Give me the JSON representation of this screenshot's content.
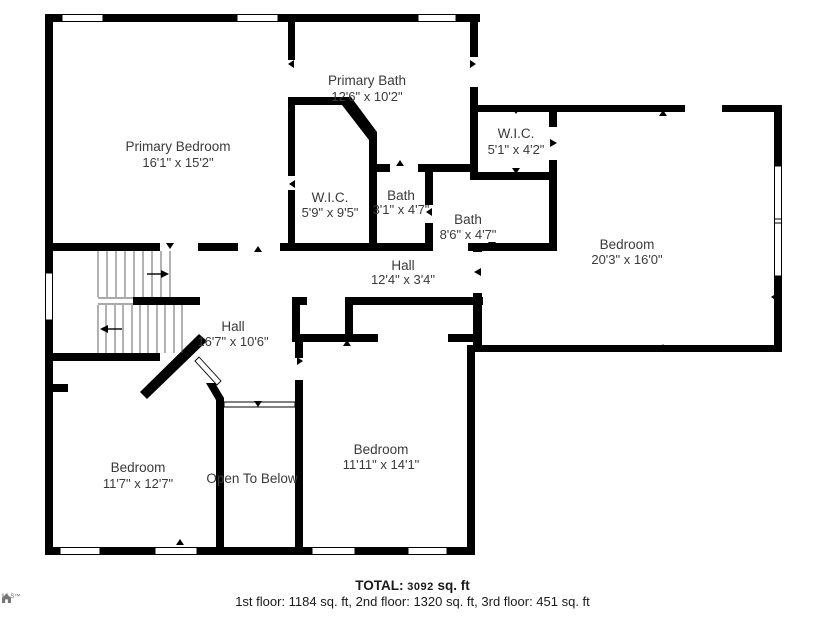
{
  "plan": {
    "wall_color": "#000000",
    "text_color": "#3a3a3a",
    "rooms": [
      {
        "name": "Primary Bedroom",
        "dims": "16'1\" x 15'2\""
      },
      {
        "name": "Primary Bath",
        "dims": "12'6\" x 10'2\""
      },
      {
        "name": "W.I.C.",
        "dims": "5'9\" x 9'5\""
      },
      {
        "name": "Bath",
        "dims": "3'1\" x 4'7\""
      },
      {
        "name": "W.I.C.",
        "dims": "5'1\" x 4'2\""
      },
      {
        "name": "Bath",
        "dims": "8'6\" x 4'7\""
      },
      {
        "name": "Hall",
        "dims": "12'4\" x 3'4\""
      },
      {
        "name": "Bedroom",
        "dims": "20'3\" x 16'0\""
      },
      {
        "name": "Hall",
        "dims": "16'7\" x 10'6\""
      },
      {
        "name": "Bedroom",
        "dims": "11'7\" x 12'7\""
      },
      {
        "name": "Open To Below",
        "dims": ""
      },
      {
        "name": "Bedroom",
        "dims": "11'11\" x 14'1\""
      }
    ]
  },
  "footer": {
    "total_label": "TOTAL:",
    "total_value": "3092",
    "total_unit": "sq. ft",
    "floors": "1st floor: 1184 sq. ft, 2nd floor: 1320 sq. ft, 3rd floor: 451 sq. ft"
  },
  "logo": {
    "text": "MLS™"
  }
}
